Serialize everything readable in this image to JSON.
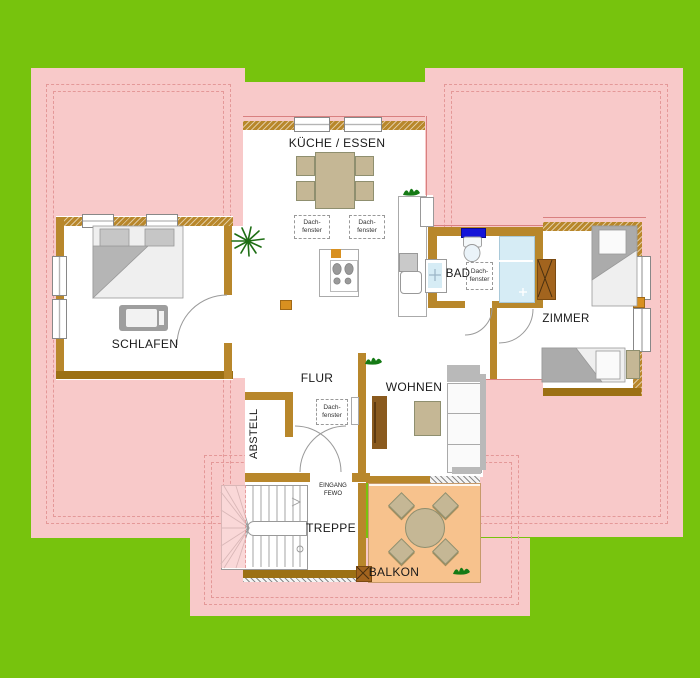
{
  "plan": {
    "rooms": {
      "kueche": "KÜCHE / ESSEN",
      "schlafen": "SCHLAFEN",
      "bad": "BAD",
      "zimmer": "ZIMMER",
      "flur": "FLUR",
      "wohnen": "WOHNEN",
      "abstell": "ABSTELL",
      "treppe": "TREPPE",
      "balkon": "BALKON"
    },
    "annotations": {
      "dach_line1": "Dach-",
      "dach_line2": "fenster",
      "eingang_line1": "EINGANG",
      "eingang_line2": "FEWO"
    },
    "colors": {
      "lawn": "#77C30D",
      "roof": "#F8C9C9",
      "roofline": "#E49898",
      "eave": "#D98080",
      "wall": "#B8872B",
      "walld": "#9C7014",
      "tan": "#C5B795",
      "balcony": "#F7C28D",
      "winblue": "#1414D8",
      "shower": "#D6ECF5",
      "chimney": "#A2641E",
      "accentsq": "#D89020",
      "plant": "#157A15"
    }
  }
}
